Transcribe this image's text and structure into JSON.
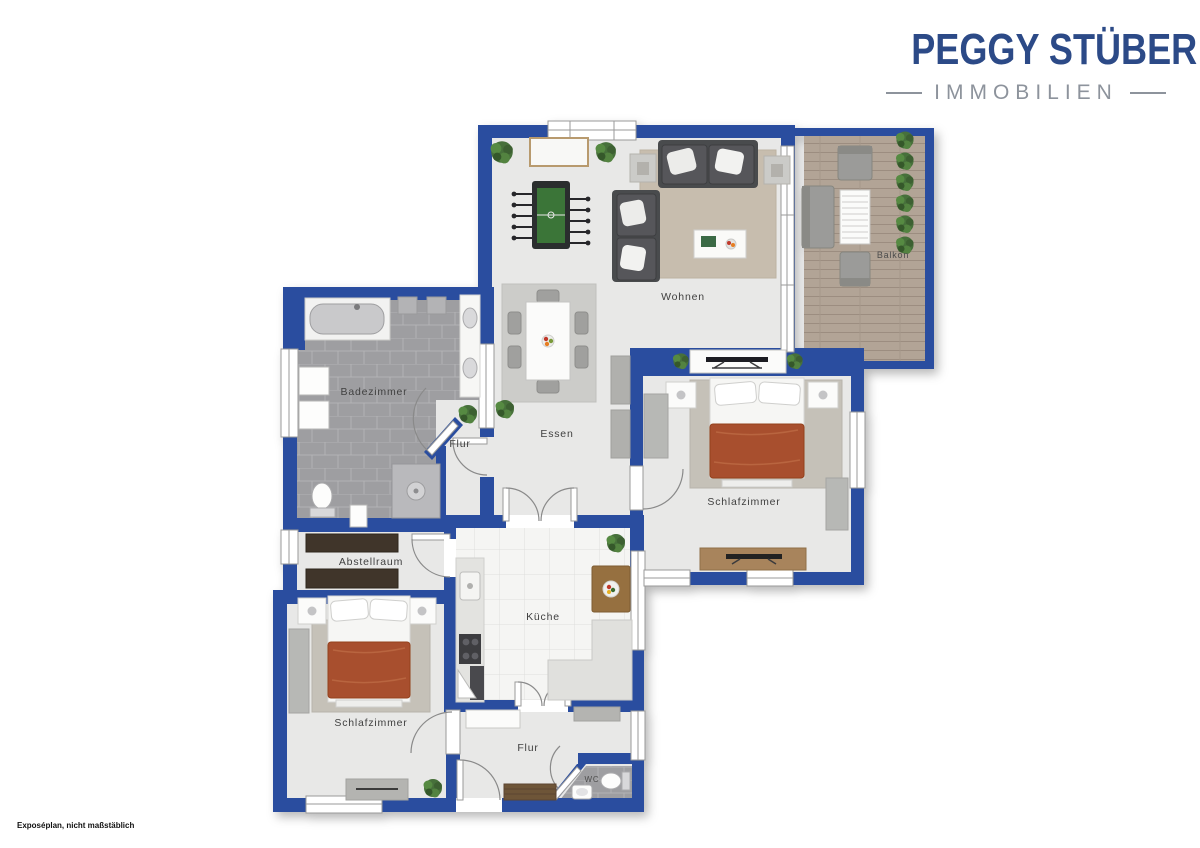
{
  "branding": {
    "name": "PEGGY STÜBER",
    "tagline": "IMMOBILIEN"
  },
  "disclaimer": "Exposéplan, nicht maßstäblich",
  "rooms": {
    "wohnen": {
      "label": "Wohnen"
    },
    "essen": {
      "label": "Essen"
    },
    "balkon": {
      "label": "Balkon"
    },
    "badezimmer": {
      "label": "Badezimmer"
    },
    "flur_mitte": {
      "label": "Flur"
    },
    "abstellraum": {
      "label": "Abstellraum"
    },
    "kueche": {
      "label": "Küche"
    },
    "schlafzimmer_rechts": {
      "label": "Schlafzimmer"
    },
    "schlafzimmer_links": {
      "label": "Schlafzimmer"
    },
    "flur_unten": {
      "label": "Flur"
    },
    "wc": {
      "label": "WC"
    }
  },
  "colors": {
    "wall_blue": "#2a4e9f",
    "brand_blue": "#2c4a87",
    "brand_gray": "#8d939c",
    "floor_gray": "#e8e8e7",
    "bath_tile_gray": "#9e9ea1",
    "kitchen_tile_white": "#f5f5f3",
    "balcony_wood": "#b2a496",
    "rug_beige": "#c7bdae",
    "bed_blanket_rust": "#a8502e",
    "sofa_dark_gray": "#4a4b4e",
    "furniture_wood": "#a8845c"
  }
}
